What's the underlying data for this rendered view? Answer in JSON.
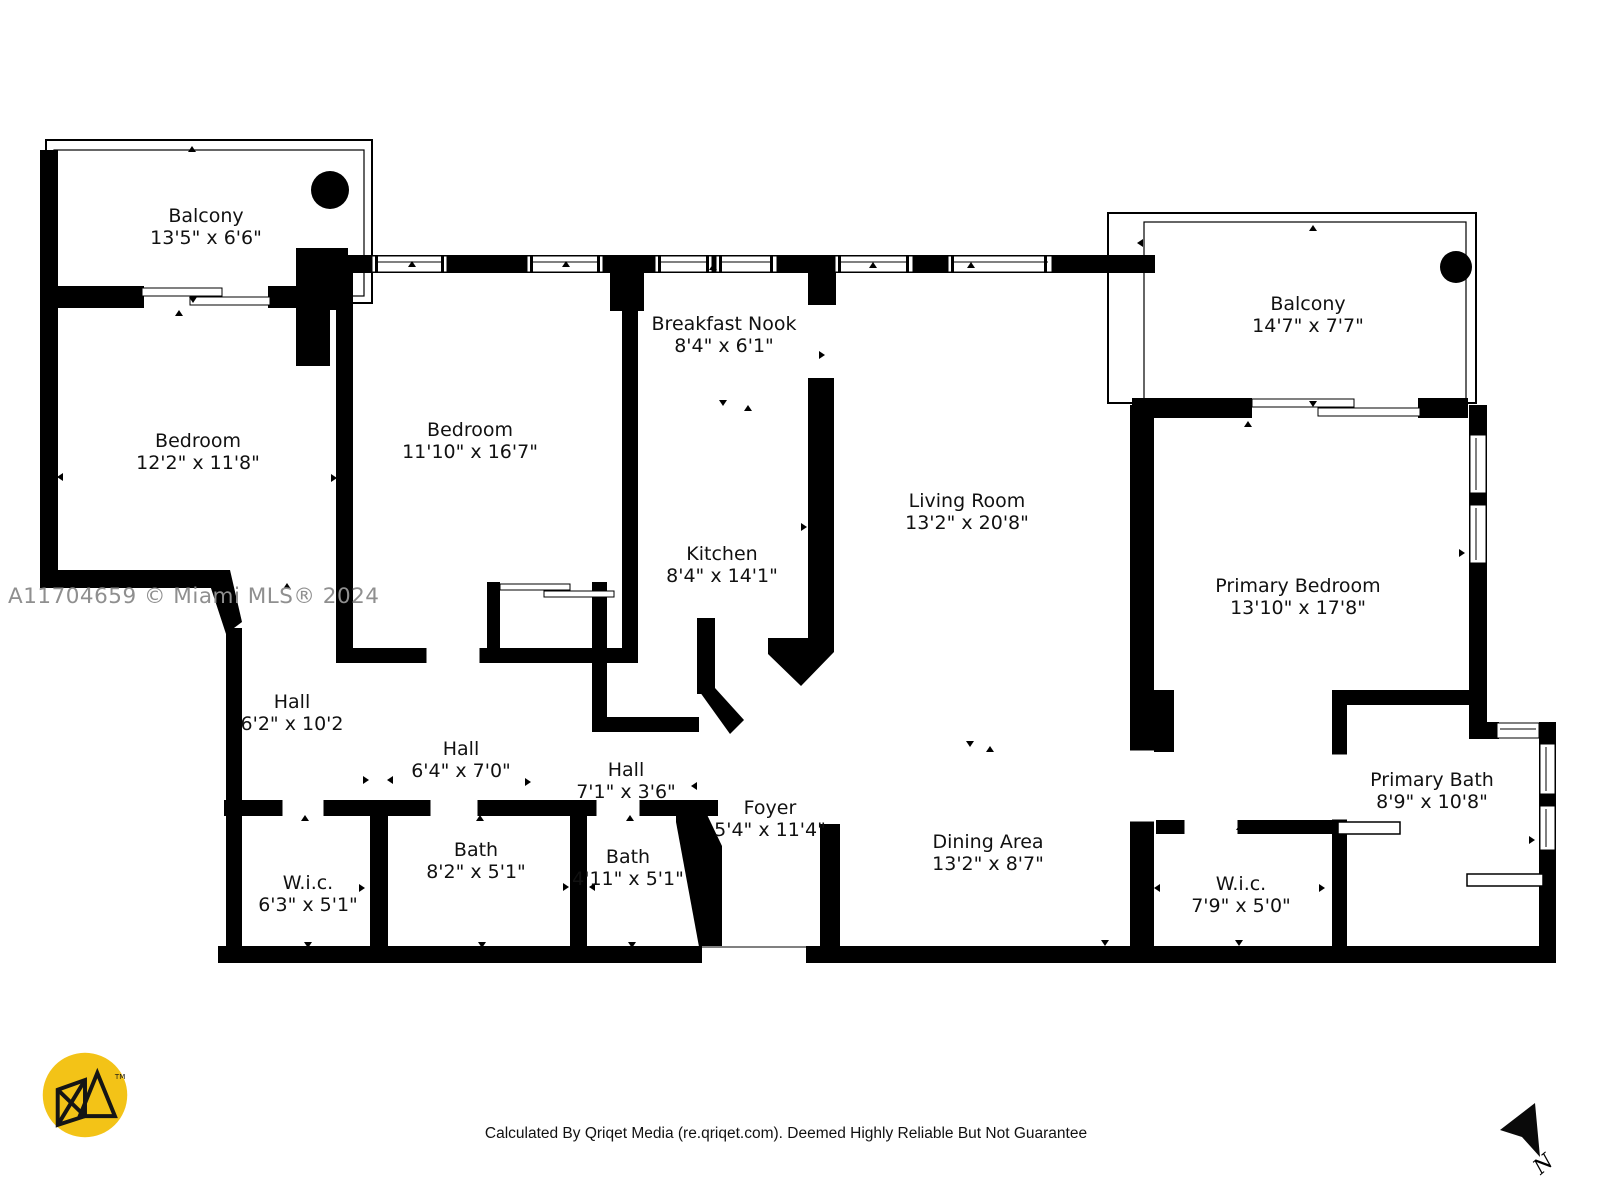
{
  "watermark": "A11704659 © Miami MLS® 2024",
  "footer": "Calculated By Qriqet Media (re.qriqet.com). Deemed Highly Reliable But Not Guarantee",
  "north": {
    "label": "N"
  },
  "logo": {
    "tm": "TM"
  },
  "colors": {
    "wall": "#000000",
    "background": "#ffffff",
    "watermark": "#8f8f8f",
    "logo_yellow": "#f3c317"
  },
  "rooms": [
    {
      "id": "balcony-left",
      "name": "Balcony",
      "dims": "13'5\" x 6'6\"",
      "x": 206,
      "y": 227
    },
    {
      "id": "bedroom-left",
      "name": "Bedroom",
      "dims": "12'2\" x 11'8\"",
      "x": 198,
      "y": 452
    },
    {
      "id": "bedroom-middle",
      "name": "Bedroom",
      "dims": "11'10\" x 16'7\"",
      "x": 470,
      "y": 441
    },
    {
      "id": "breakfast-nook",
      "name": "Breakfast Nook",
      "dims": "8'4\" x 6'1\"",
      "x": 724,
      "y": 335
    },
    {
      "id": "kitchen",
      "name": "Kitchen",
      "dims": "8'4\" x 14'1\"",
      "x": 722,
      "y": 565
    },
    {
      "id": "living-room",
      "name": "Living Room",
      "dims": "13'2\" x 20'8\"",
      "x": 967,
      "y": 512
    },
    {
      "id": "balcony-right",
      "name": "Balcony",
      "dims": "14'7\" x 7'7\"",
      "x": 1308,
      "y": 315
    },
    {
      "id": "primary-bedroom",
      "name": "Primary Bedroom",
      "dims": "13'10\" x 17'8\"",
      "x": 1298,
      "y": 597
    },
    {
      "id": "hall-1",
      "name": "Hall",
      "dims": "6'2\" x 10'2",
      "x": 292,
      "y": 713
    },
    {
      "id": "hall-2",
      "name": "Hall",
      "dims": "6'4\" x 7'0\"",
      "x": 461,
      "y": 760
    },
    {
      "id": "hall-3",
      "name": "Hall",
      "dims": "7'1\" x 3'6\"",
      "x": 626,
      "y": 781
    },
    {
      "id": "foyer",
      "name": "Foyer",
      "dims": "5'4\" x 11'4\"",
      "x": 770,
      "y": 819
    },
    {
      "id": "dining-area",
      "name": "Dining Area",
      "dims": "13'2\" x 8'7\"",
      "x": 988,
      "y": 853
    },
    {
      "id": "bath-1",
      "name": "Bath",
      "dims": "8'2\" x 5'1\"",
      "x": 476,
      "y": 861
    },
    {
      "id": "bath-2",
      "name": "Bath",
      "dims": "4'11\" x 5'1\"",
      "x": 628,
      "y": 868
    },
    {
      "id": "wic-1",
      "name": "W.i.c.",
      "dims": "6'3\" x 5'1\"",
      "x": 308,
      "y": 894
    },
    {
      "id": "wic-2",
      "name": "W.i.c.",
      "dims": "7'9\" x 5'0\"",
      "x": 1241,
      "y": 895
    },
    {
      "id": "primary-bath",
      "name": "Primary Bath",
      "dims": "8'9\" x 10'8\"",
      "x": 1432,
      "y": 791
    }
  ],
  "markers": [
    {
      "x": 192,
      "y": 149,
      "d": "up"
    },
    {
      "x": 193,
      "y": 300,
      "d": "down"
    },
    {
      "x": 179,
      "y": 313,
      "d": "up"
    },
    {
      "x": 60,
      "y": 477,
      "d": "left"
    },
    {
      "x": 334,
      "y": 478,
      "d": "right"
    },
    {
      "x": 180,
      "y": 583,
      "d": "down"
    },
    {
      "x": 287,
      "y": 586,
      "d": "up"
    },
    {
      "x": 412,
      "y": 264,
      "d": "up"
    },
    {
      "x": 566,
      "y": 264,
      "d": "up"
    },
    {
      "x": 713,
      "y": 267,
      "d": "up"
    },
    {
      "x": 873,
      "y": 265,
      "d": "up"
    },
    {
      "x": 971,
      "y": 265,
      "d": "up"
    },
    {
      "x": 723,
      "y": 403,
      "d": "down"
    },
    {
      "x": 748,
      "y": 408,
      "d": "up"
    },
    {
      "x": 822,
      "y": 355,
      "d": "right"
    },
    {
      "x": 628,
      "y": 356,
      "d": "left"
    },
    {
      "x": 628,
      "y": 527,
      "d": "left"
    },
    {
      "x": 804,
      "y": 527,
      "d": "right"
    },
    {
      "x": 970,
      "y": 744,
      "d": "down"
    },
    {
      "x": 990,
      "y": 749,
      "d": "up"
    },
    {
      "x": 1313,
      "y": 228,
      "d": "up"
    },
    {
      "x": 1313,
      "y": 404,
      "d": "down"
    },
    {
      "x": 1248,
      "y": 424,
      "d": "up"
    },
    {
      "x": 1140,
      "y": 243,
      "d": "left"
    },
    {
      "x": 1148,
      "y": 552,
      "d": "left"
    },
    {
      "x": 1462,
      "y": 553,
      "d": "right"
    },
    {
      "x": 1405,
      "y": 701,
      "d": "up"
    },
    {
      "x": 1337,
      "y": 840,
      "d": "left"
    },
    {
      "x": 1532,
      "y": 840,
      "d": "right"
    },
    {
      "x": 480,
      "y": 818,
      "d": "up"
    },
    {
      "x": 482,
      "y": 945,
      "d": "down"
    },
    {
      "x": 305,
      "y": 818,
      "d": "up"
    },
    {
      "x": 308,
      "y": 945,
      "d": "down"
    },
    {
      "x": 630,
      "y": 818,
      "d": "up"
    },
    {
      "x": 632,
      "y": 945,
      "d": "down"
    },
    {
      "x": 232,
      "y": 887,
      "d": "left"
    },
    {
      "x": 362,
      "y": 888,
      "d": "right"
    },
    {
      "x": 566,
      "y": 887,
      "d": "right"
    },
    {
      "x": 592,
      "y": 887,
      "d": "left"
    },
    {
      "x": 366,
      "y": 780,
      "d": "right"
    },
    {
      "x": 390,
      "y": 780,
      "d": "left"
    },
    {
      "x": 528,
      "y": 782,
      "d": "right"
    },
    {
      "x": 694,
      "y": 786,
      "d": "left"
    },
    {
      "x": 712,
      "y": 888,
      "d": "right"
    },
    {
      "x": 1240,
      "y": 827,
      "d": "up"
    },
    {
      "x": 1239,
      "y": 943,
      "d": "down"
    },
    {
      "x": 1157,
      "y": 888,
      "d": "left"
    },
    {
      "x": 1322,
      "y": 888,
      "d": "right"
    },
    {
      "x": 1105,
      "y": 943,
      "d": "down"
    }
  ]
}
